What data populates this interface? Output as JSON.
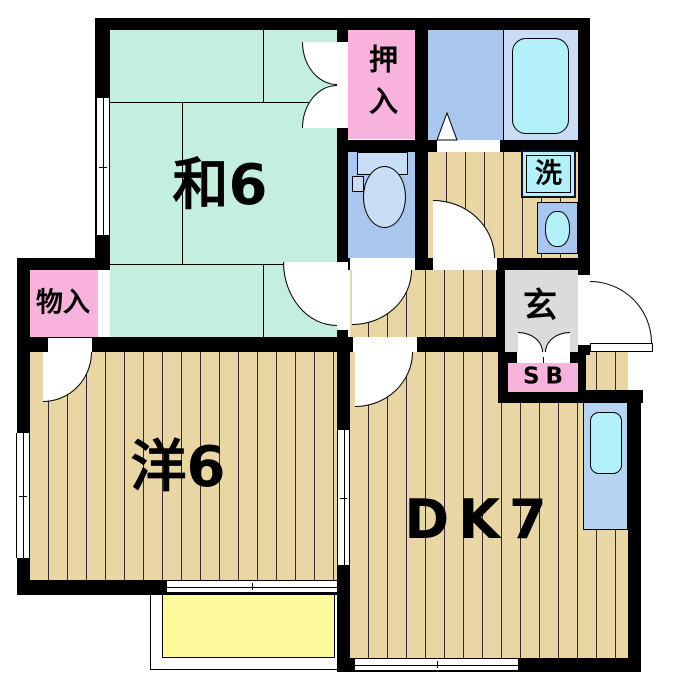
{
  "rooms": {
    "washitsu": {
      "label": "和6"
    },
    "western": {
      "label": "洋6"
    },
    "dining_kitchen": {
      "label": "DK7"
    },
    "oshiire": {
      "label": "押入"
    },
    "monoire": {
      "label": "物入"
    },
    "genkan": {
      "label": "玄"
    },
    "shoe_box": {
      "label": "SB"
    },
    "laundry": {
      "label": "洗"
    }
  },
  "colors": {
    "wall": "#000000",
    "tatami": "#c4eede",
    "wood": "#e9d6a4",
    "plank": "#2e2e2e",
    "pink": "#f7b3dc",
    "wet": "#a8c6ee",
    "bathR": "#cbdcf6",
    "cyan": "#b2f1fa",
    "fixture": "#c8def7",
    "gray": "#dbdbdb",
    "yellow": "#fcfa9b",
    "counter": "#b5d4f4",
    "lborder": "#111133"
  }
}
